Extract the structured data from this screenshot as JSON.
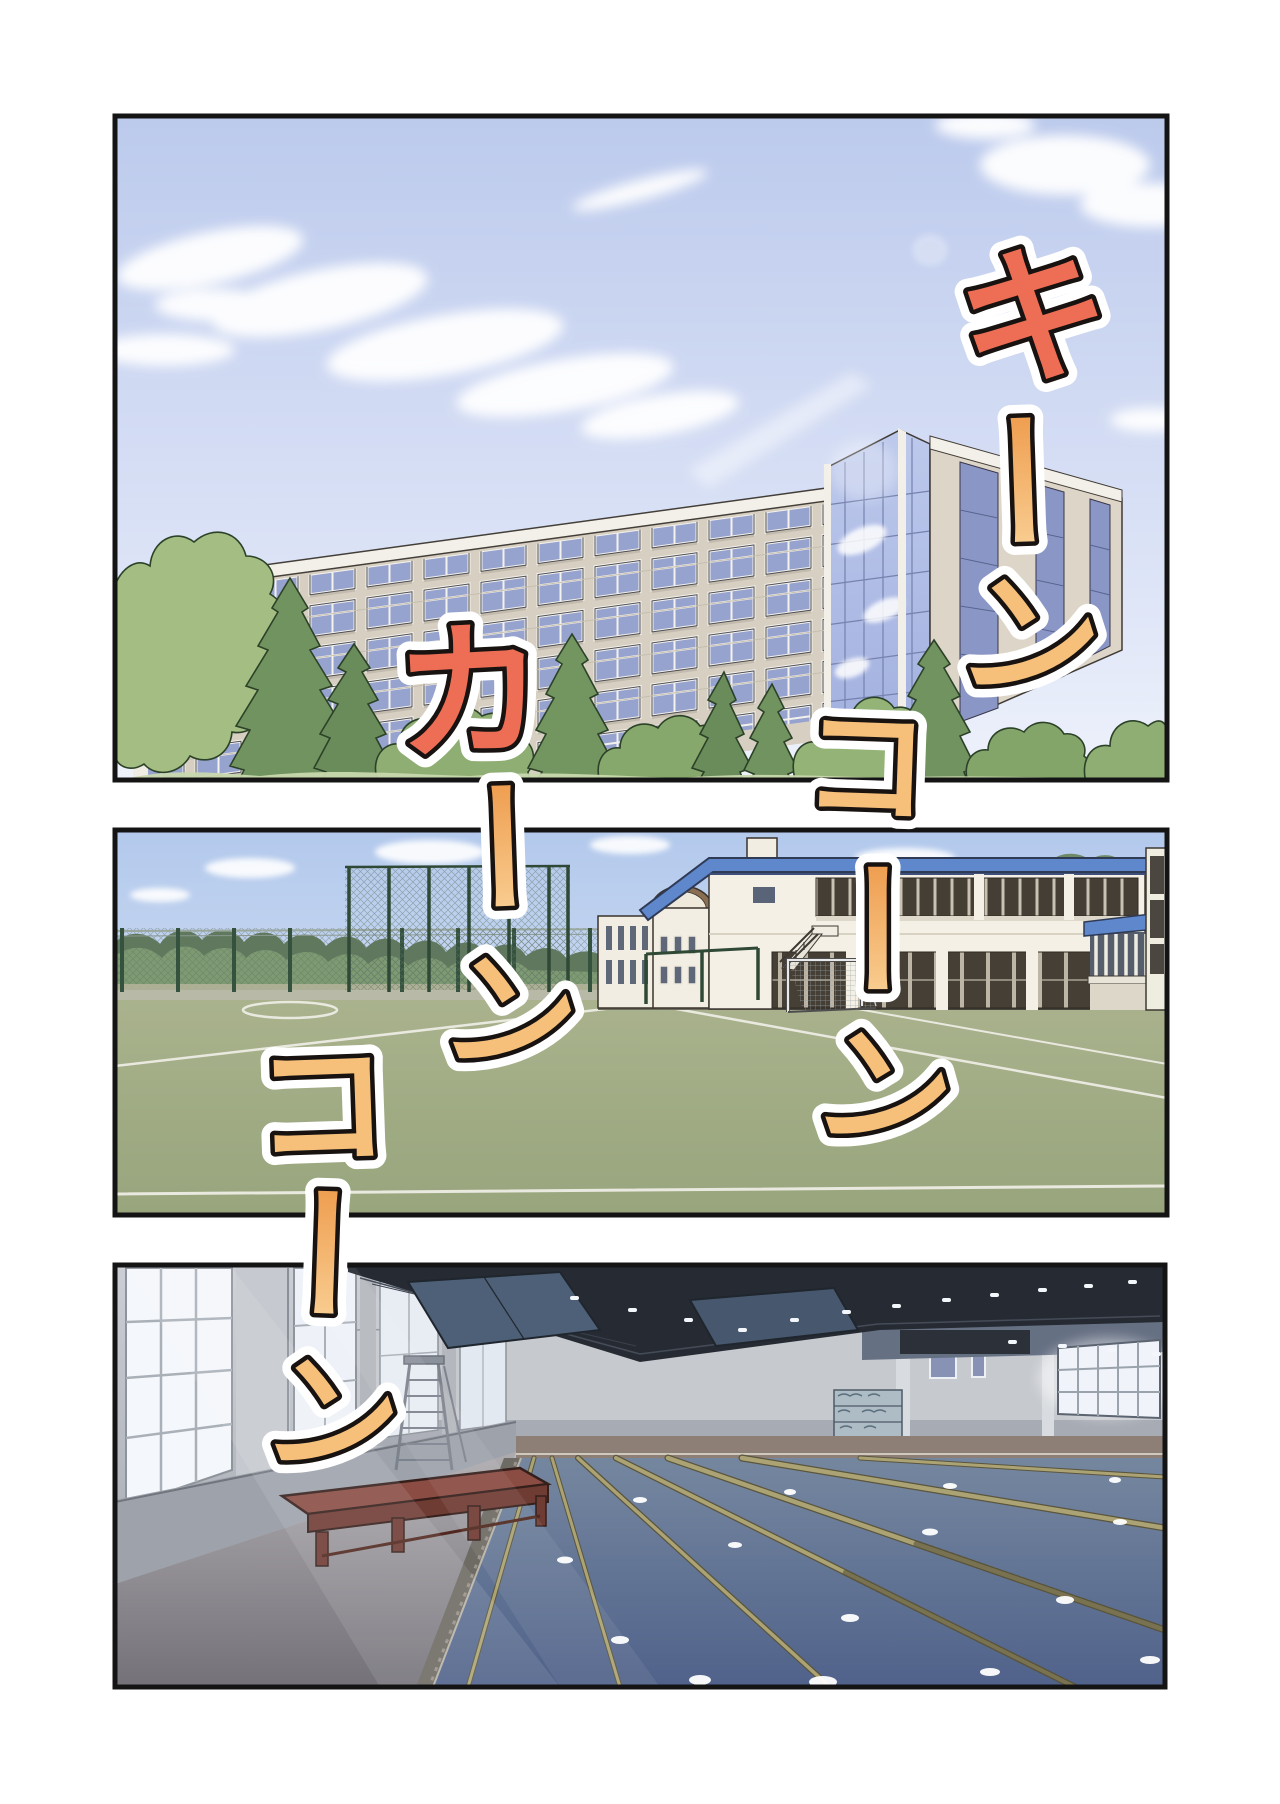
{
  "sfx": {
    "kiin": {
      "char1": "キ",
      "char2": "ー",
      "char3": "ン"
    },
    "koon_right": {
      "char1": "コ",
      "char2": "ー",
      "char3": "ン"
    },
    "kaan": {
      "char1": "カ",
      "char2": "ー",
      "char3": "ン"
    },
    "koon_left": {
      "char1": "コ",
      "char2": "ー",
      "char3": "ン"
    }
  },
  "colors": {
    "sfx_red": "#ee6d55",
    "sfx_orange": "#f6c07a",
    "sfx_orange_deep": "#ef9c4e",
    "sfx_outline": "#181310",
    "sfx_halo": "#ffffff",
    "panel_border": "#141414",
    "sky": "#c3cfee",
    "field_green": "#a3ad87",
    "gym_roof_blue": "#5f87cb",
    "pool_water": "#5f7397",
    "lane_rope": "#a59d6c"
  }
}
